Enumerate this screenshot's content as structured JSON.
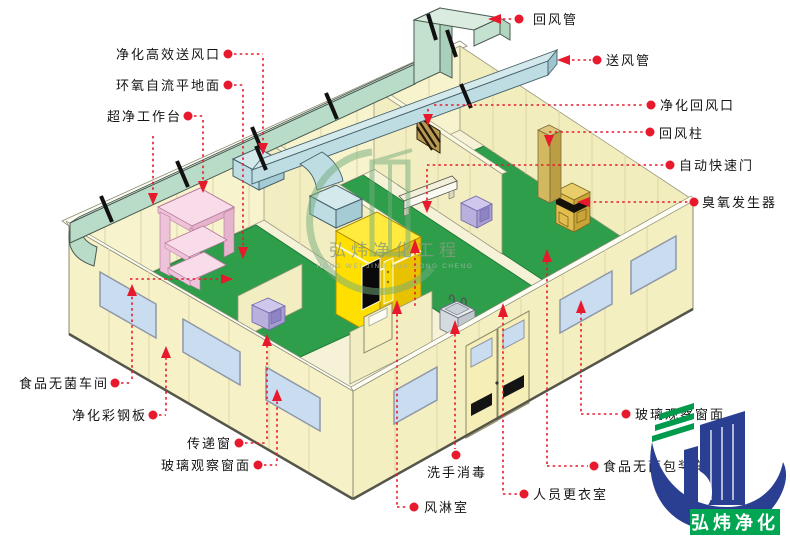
{
  "colors": {
    "annotation_red": "#e8192c",
    "wall_cream": "#f7f3cd",
    "floor_green": "#2f9e4b",
    "return_duct_green": "#b9dcc8",
    "supply_duct_blue": "#bddde3",
    "window_blue": "#cadcf0",
    "air_shower_yellow": "#ffdf00",
    "workbench_pink": "#f8dcea",
    "logo_green": "#00a651",
    "logo_blue": "#2a3f92"
  },
  "labels": {
    "return_duct": "回风管",
    "supply_duct": "送风管",
    "purif_return_vent": "净化回风口",
    "return_column": "回风柱",
    "auto_rapid_door": "自动快速门",
    "ozone_generator": "臭氧发生器",
    "glass_window_right": "玻璃观察窗面",
    "food_packing_room": "食品无菌包装车间",
    "changing_room": "人员更衣室",
    "hand_wash": "洗手消毒",
    "air_shower": "风淋室",
    "hepa_supply_vent": "净化高效送风口",
    "epoxy_floor": "环氧自流平地面",
    "clean_bench": "超净工作台",
    "food_clean_room": "食品无菌车间",
    "clean_steel_panel": "净化彩钢板",
    "transfer_window": "传递窗",
    "glass_window_left": "玻璃观察窗面"
  },
  "watermark": {
    "cn": "弘炜净化工程",
    "en": "HONG WEI JING HUA GONG CHENG"
  },
  "brand": {
    "name": "弘炜净化"
  }
}
